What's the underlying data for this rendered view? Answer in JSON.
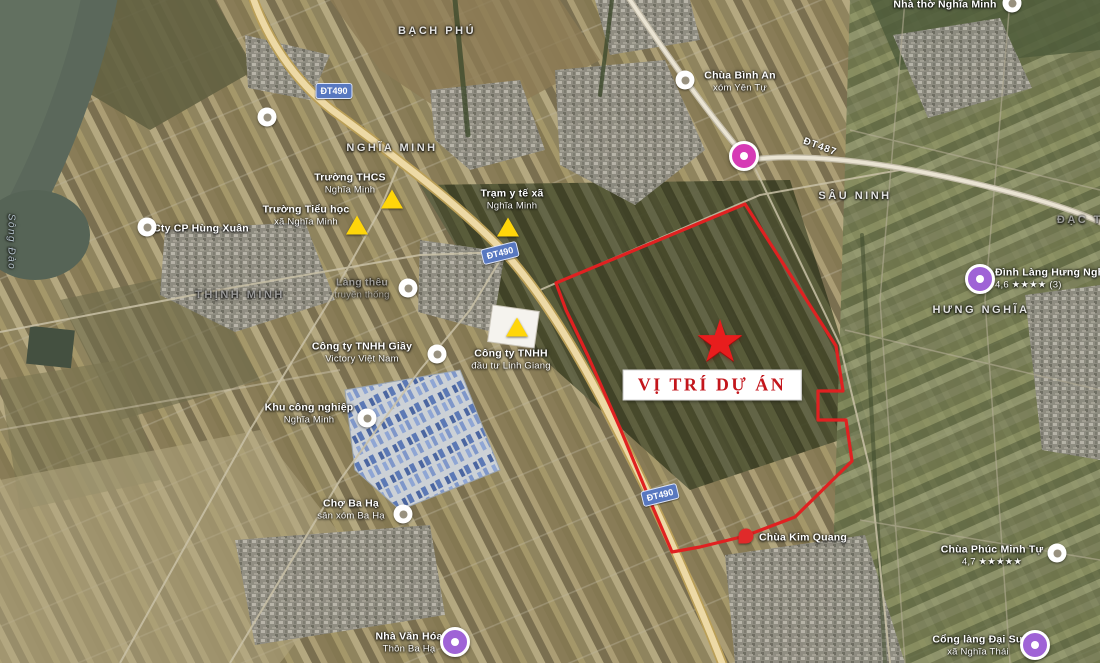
{
  "project": {
    "label": "VỊ TRÍ DỰ ÁN",
    "star": {
      "x": 720,
      "y": 342
    },
    "box": {
      "x": 712,
      "y": 385
    }
  },
  "colors": {
    "boundary_red": "#e81f1f",
    "project_text_red": "#c3161c",
    "triangle_yellow": "#ffd60a",
    "poi_pink": "#d63bb5",
    "poi_purple": "#9f63d6",
    "shield_blue": "#5878c0"
  },
  "map": {
    "labels": [
      {
        "name": "label-truong-thcs-nghia-minh",
        "kind": "poi",
        "x": 350,
        "y": 184,
        "lines": [
          "Trường THCS",
          "Nghĩa Minh"
        ]
      },
      {
        "name": "label-truong-tieu-hoc",
        "kind": "poi",
        "x": 306,
        "y": 216,
        "lines": [
          "Trường Tiểu học",
          "xã Nghĩa Minh"
        ]
      },
      {
        "name": "label-tram-y-te",
        "kind": "poi",
        "x": 512,
        "y": 200,
        "lines": [
          "Trạm y tế xã",
          "Nghĩa Minh"
        ]
      },
      {
        "name": "label-cty-giay-victory",
        "kind": "poi",
        "x": 362,
        "y": 353,
        "lines": [
          "Công ty TNHH Giầy",
          "Victory Việt Nam"
        ]
      },
      {
        "name": "label-cty-linh-giang",
        "kind": "poi",
        "x": 511,
        "y": 360,
        "lines": [
          "Công ty TNHH",
          "đầu tư Linh Giang"
        ]
      },
      {
        "name": "label-khu-cong-nghiep",
        "kind": "poi",
        "x": 309,
        "y": 414,
        "lines": [
          "Khu công nghiệp",
          "Nghĩa Minh"
        ]
      },
      {
        "name": "label-cho-ba-ha",
        "kind": "poi",
        "x": 351,
        "y": 510,
        "lines": [
          "Chợ Ba Hạ",
          "sân xóm Ba Hạ"
        ]
      },
      {
        "name": "label-cty-hung-xuan",
        "kind": "poi",
        "x": 201,
        "y": 229,
        "lines": [
          "Cty CP Hùng Xuân"
        ]
      },
      {
        "name": "label-chua-binh-an",
        "kind": "poi",
        "x": 740,
        "y": 82,
        "lines": [
          "Chùa Bình An",
          "xóm Yên Tự"
        ]
      },
      {
        "name": "label-dinh-lang-hung-nghia",
        "kind": "poi",
        "align": "left",
        "x": 995,
        "y": 279,
        "lines": [
          "Đình Làng Hưng Nghĩa",
          "4,6 ★★★★ (3)"
        ]
      },
      {
        "name": "label-chua-phuc-minh-tu",
        "kind": "poi",
        "x": 992,
        "y": 556,
        "lines": [
          "Chùa Phúc Minh Tự",
          "4,7 ★★★★★"
        ]
      },
      {
        "name": "label-cong-lang-dai-su",
        "kind": "poi",
        "x": 978,
        "y": 646,
        "lines": [
          "Cổng làng Đại Sư",
          "xã Nghĩa Thái"
        ]
      },
      {
        "name": "label-nha-van-hoa-ba-ha",
        "kind": "poi",
        "x": 409,
        "y": 643,
        "lines": [
          "Nhà Văn Hóa",
          "Thôn Ba Hạ"
        ]
      },
      {
        "name": "label-chua-kim-quang",
        "kind": "poi",
        "x": 803,
        "y": 538,
        "lines": [
          "Chùa Kim Quang"
        ]
      },
      {
        "name": "label-nha-tho-nghia-minh",
        "kind": "poi",
        "x": 945,
        "y": 5,
        "lines": [
          "Nhà thờ Nghĩa Minh"
        ]
      },
      {
        "name": "label-lang-theu",
        "kind": "poi",
        "faint": true,
        "x": 362,
        "y": 289,
        "lines": [
          "Làng thêu",
          "truyền thống"
        ]
      },
      {
        "name": "label-area-bach-phu",
        "kind": "area",
        "x": 437,
        "y": 32,
        "lines": [
          "Bạch Phú"
        ]
      },
      {
        "name": "label-area-nghia-minh",
        "kind": "area",
        "x": 392,
        "y": 149,
        "lines": [
          "Nghĩa Minh"
        ]
      },
      {
        "name": "label-area-sau-ninh",
        "kind": "area",
        "x": 855,
        "y": 197,
        "lines": [
          "Sâu Ninh"
        ]
      },
      {
        "name": "label-area-hung-nghia",
        "kind": "area",
        "x": 981,
        "y": 311,
        "lines": [
          "Hưng Nghĩa"
        ]
      },
      {
        "name": "label-area-thinh-minh",
        "kind": "area",
        "faint": true,
        "x": 240,
        "y": 296,
        "lines": [
          "Thịnh Minh"
        ]
      },
      {
        "name": "label-area-dac-thu",
        "kind": "area",
        "faint": true,
        "x": 1091,
        "y": 221,
        "lines": [
          "Đạc Thư"
        ]
      },
      {
        "name": "label-song-dao",
        "kind": "river",
        "rotate": 90,
        "x": 10,
        "y": 242,
        "lines": [
          "Sông Đào"
        ]
      }
    ],
    "markers": [
      {
        "name": "marker-triangle-thcs",
        "type": "tri",
        "x": 392,
        "y": 199
      },
      {
        "name": "marker-triangle-tieu-hoc",
        "type": "tri",
        "x": 357,
        "y": 225
      },
      {
        "name": "marker-triangle-tram-y-te",
        "type": "tri",
        "x": 508,
        "y": 227
      },
      {
        "name": "marker-triangle-linh-giang",
        "type": "tri",
        "x": 517,
        "y": 327
      },
      {
        "name": "marker-poi-hung-xuan",
        "type": "poi",
        "x": 147,
        "y": 227
      },
      {
        "name": "marker-poi-road-bend",
        "type": "poi",
        "x": 267,
        "y": 117
      },
      {
        "name": "marker-poi-lang-theu",
        "type": "poi",
        "x": 408,
        "y": 288
      },
      {
        "name": "marker-poi-victory",
        "type": "poi",
        "x": 437,
        "y": 354
      },
      {
        "name": "marker-poi-kcn",
        "type": "poi",
        "x": 367,
        "y": 418
      },
      {
        "name": "marker-poi-cho-ba-ha",
        "type": "poi",
        "x": 403,
        "y": 514
      },
      {
        "name": "marker-poi-chua-binh-an",
        "type": "poi",
        "x": 685,
        "y": 80
      },
      {
        "name": "marker-poi-nha-tho",
        "type": "poi",
        "x": 1012,
        "y": 3
      },
      {
        "name": "marker-poi-chua-phuc-minh",
        "type": "poi",
        "x": 1057,
        "y": 553
      },
      {
        "name": "marker-pink-junction",
        "type": "pink",
        "x": 744,
        "y": 156
      },
      {
        "name": "marker-purple-dinh-lang",
        "type": "purple",
        "x": 980,
        "y": 279
      },
      {
        "name": "marker-purple-nha-van-hoa",
        "type": "purple",
        "x": 455,
        "y": 642
      },
      {
        "name": "marker-purple-cong-lang",
        "type": "purple",
        "x": 1035,
        "y": 645
      },
      {
        "name": "marker-red-chua-kim-quang",
        "type": "reddot",
        "x": 746,
        "y": 536
      }
    ],
    "road_shields": [
      {
        "name": "shield-dt490-top",
        "text": "ĐT490",
        "x": 334,
        "y": 91,
        "rotate": 0
      },
      {
        "name": "shield-dt490-mid",
        "text": "ĐT490",
        "x": 500,
        "y": 253,
        "rotate": -14
      },
      {
        "name": "shield-dt490-bottom",
        "text": "ĐT490",
        "x": 660,
        "y": 495,
        "rotate": -14
      }
    ],
    "road_names": [
      {
        "name": "roadname-dt487",
        "text": "ĐT487",
        "x": 820,
        "y": 147,
        "rotate": 20
      }
    ]
  }
}
